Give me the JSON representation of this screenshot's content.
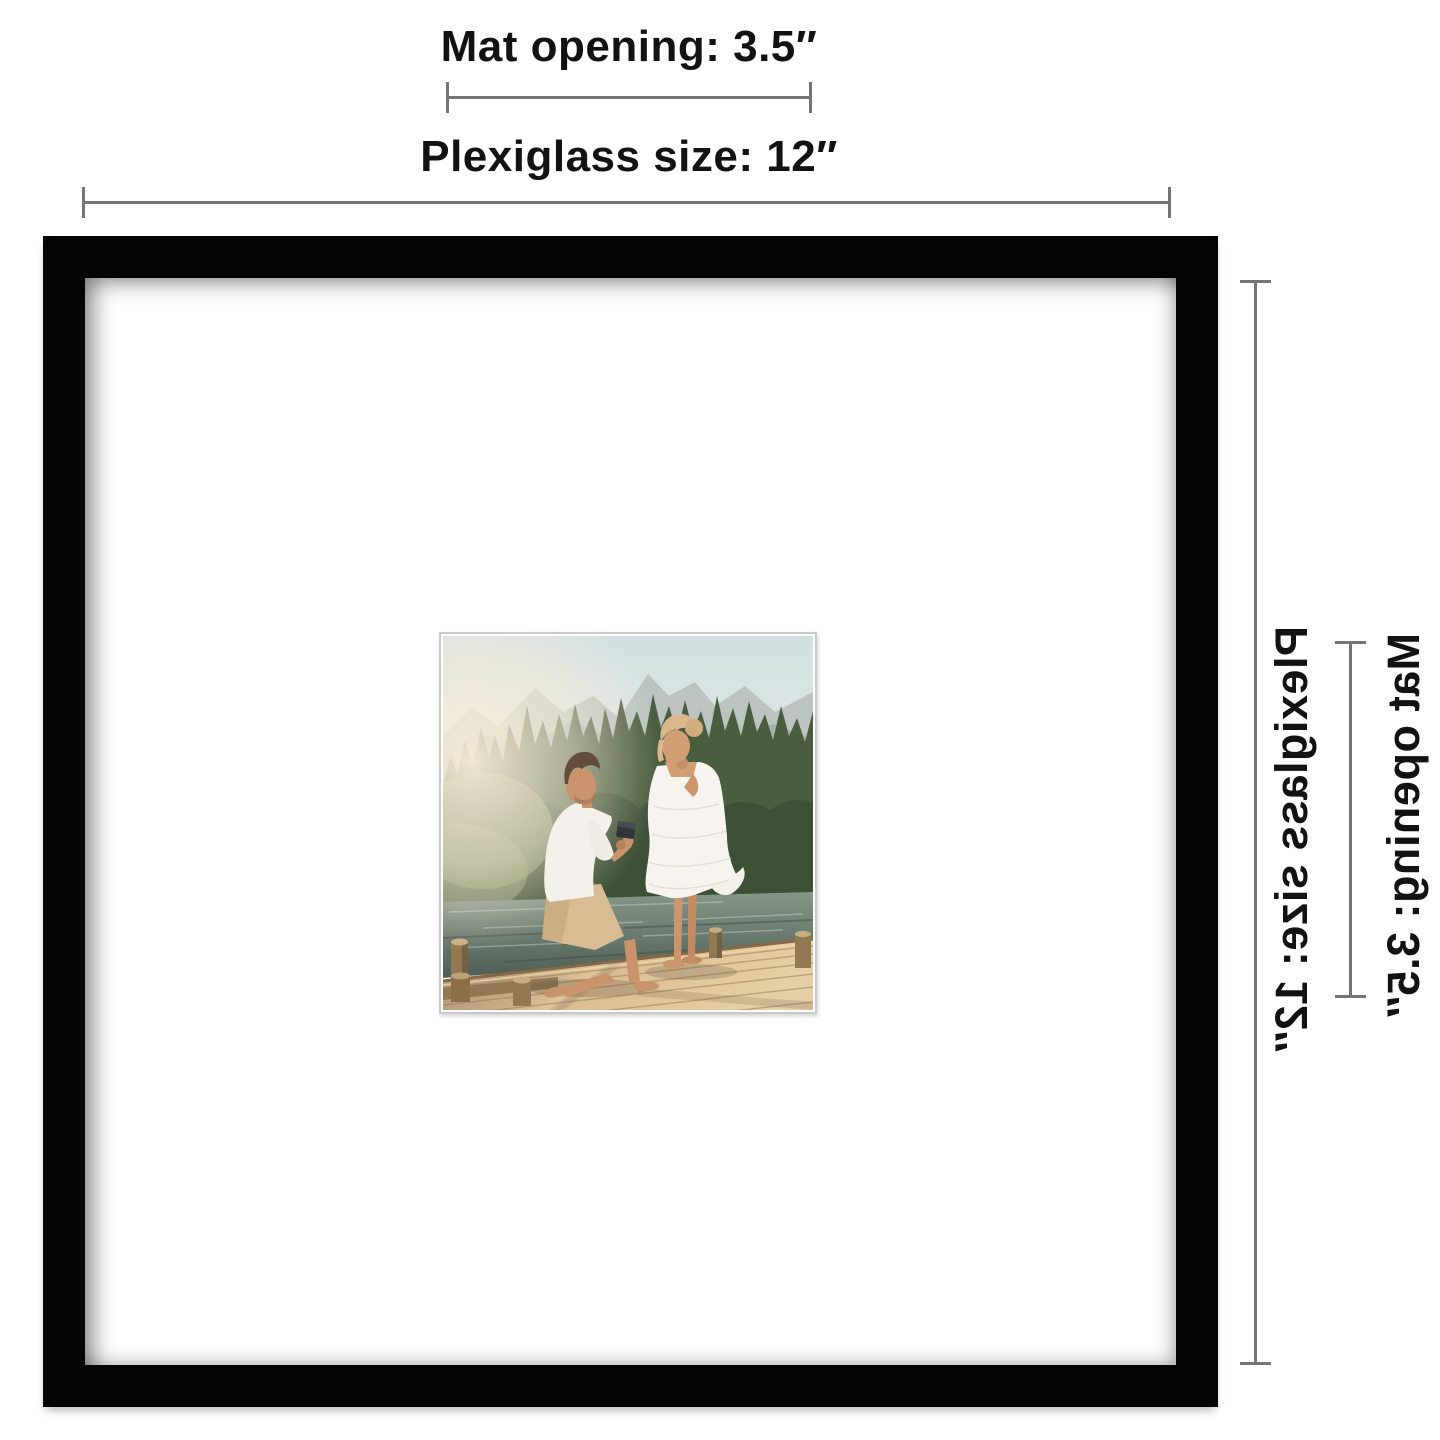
{
  "annotations": {
    "top": {
      "mat_opening_label": "Mat opening: 3.5″",
      "plexiglass_label": "Plexiglass size: 12″"
    },
    "right": {
      "plexiglass_label": "Plexiglass size: 12″",
      "mat_opening_label": "Mat opening: 3.5″"
    },
    "line_color": "#757575",
    "text_color": "#121212"
  },
  "frame": {
    "frame_color": "#040404",
    "mat_color": "#ffffff",
    "photo_border_color": "#c9c9c9",
    "photo_subject": "Man kneeling and proposing with a ring to a woman in a white dress on a wooden lake dock with pine trees and mountains"
  }
}
